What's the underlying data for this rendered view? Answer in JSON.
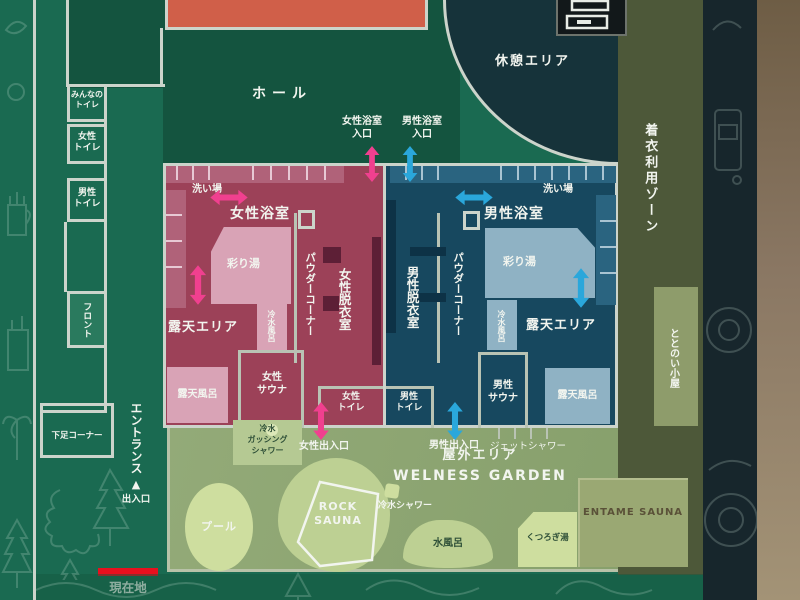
{
  "colors": {
    "map_green": "#1a6a51",
    "hall_green": "#14543f",
    "rest_dark": "#16333a",
    "women_zone": "#9c4158",
    "women_light": "#d9a3b6",
    "men_zone": "#17485f",
    "men_light": "#8fb2c4",
    "garden": "#8ba272",
    "garden_light": "#bdd093",
    "garden_lighter": "#cede9f",
    "olive_zone": "#4d5839",
    "olive_light": "#8e9c6b",
    "entame_fill": "#9aa873",
    "wall": "#ccd4cb",
    "arrow_pink": "#f0408f",
    "arrow_blue": "#2aa7db",
    "current_red": "#e8101e",
    "orange_room": "#d05f49",
    "navy_strip": "#17262c",
    "wood_edge": "#8a7763",
    "text_dark_green": "#2f5038",
    "entame_text": "#5a5138",
    "bottom_strip": "#14563f"
  },
  "labels": {
    "hall": "ホール",
    "rest_area": "休憩エリア",
    "clothed_zone": "着衣利用ゾーン",
    "everyone_toilet": "みんなの\nトイレ",
    "women_toilet_nw": "女性\nトイレ",
    "men_toilet_nw": "男性\nトイレ",
    "front_desk": "フロント",
    "entrance": "エントランス",
    "shoe_corner": "下足コーナー",
    "exit_gate": "出入口",
    "current_location": "現在地",
    "women_bath_entrance": "女性浴室\n入口",
    "men_bath_entrance": "男性浴室\n入口",
    "women_bath": "女性浴室",
    "men_bath": "男性浴室",
    "washing_area_w": "洗い場",
    "washing_area_m": "洗い場",
    "irodori_bath_w": "彩り湯",
    "irodori_bath_m": "彩り湯",
    "powder_corner_w": "パウダーコーナー",
    "powder_corner_m": "パウダーコーナー",
    "women_dressing": "女性脱衣室",
    "men_dressing": "男性脱衣室",
    "cold_bath_w": "冷水風呂",
    "cold_bath_m": "冷水風呂",
    "open_air_area_w": "露天エリア",
    "open_air_area_m": "露天エリア",
    "open_air_bath_w": "露天風呂",
    "open_air_bath_m": "露天風呂",
    "women_sauna": "女性\nサウナ",
    "men_sauna": "男性\nサウナ",
    "women_toilet_bath": "女性\nトイレ",
    "men_toilet_bath": "男性\nトイレ",
    "women_exit": "女性出入口",
    "men_exit": "男性出入口",
    "gushing_shower": "冷水\nガッシング\nシャワー",
    "jet_shower": "ジェットシャワー",
    "outdoor_area": "屋外エリア",
    "wellness_garden": "WELNESS GARDEN",
    "pool": "プール",
    "rock_sauna": "ROCK\nSAUNA",
    "cold_shower": "冷水シャワー",
    "water_bath": "水風呂",
    "kutsurogi_bath": "くつろぎ湯",
    "entame_sauna": "ENTAME SAUNA",
    "totonoi_hut": "ととのい小屋",
    "exit_marker": "▲"
  }
}
